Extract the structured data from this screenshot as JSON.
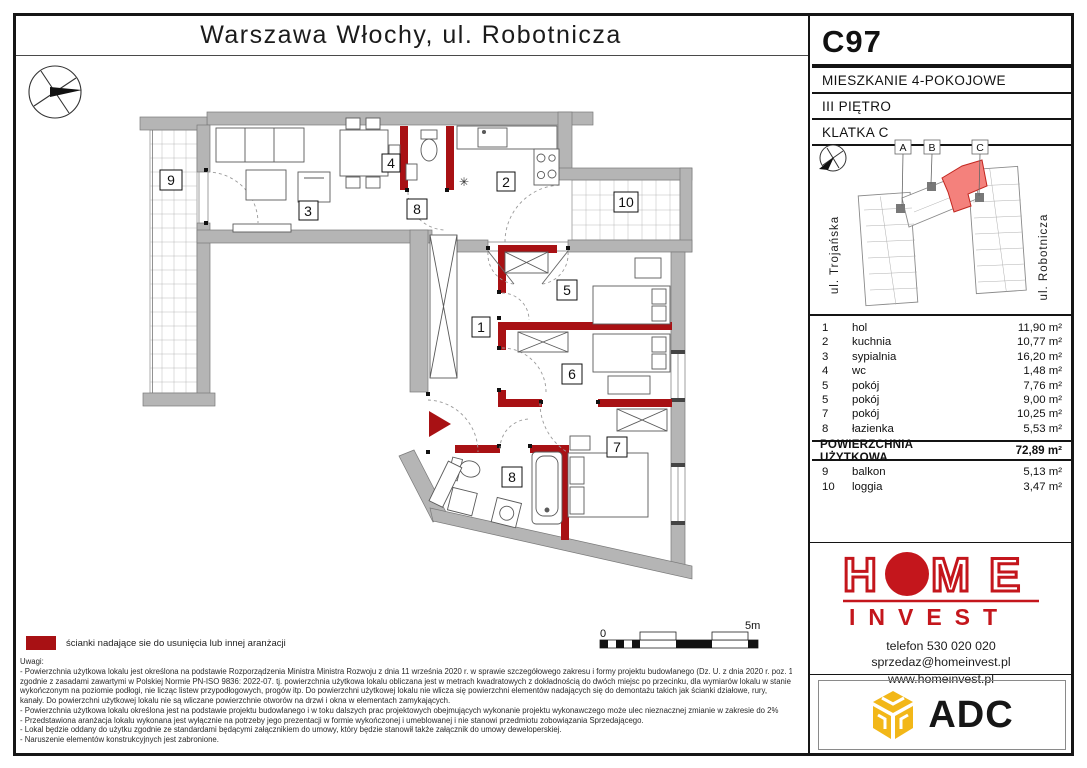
{
  "title": "Warszawa Włochy, ul. Robotnicza",
  "unit": {
    "code": "C97",
    "type": "MIESZKANIE 4-POKOJOWE",
    "floor": "III PIĘTRO",
    "staircase": "KLATKA C"
  },
  "map": {
    "building_labels": [
      "A",
      "B",
      "C"
    ],
    "street_left": "ul. Trojańska",
    "street_right": "ul. Robotnicza"
  },
  "table": {
    "rooms": [
      {
        "no": "1",
        "name": "hol",
        "area": "11,90 m²"
      },
      {
        "no": "2",
        "name": "kuchnia",
        "area": "10,77 m²"
      },
      {
        "no": "3",
        "name": "sypialnia",
        "area": "16,20 m²"
      },
      {
        "no": "4",
        "name": "wc",
        "area": "1,48 m²"
      },
      {
        "no": "5",
        "name": "pokój",
        "area": "7,76 m²"
      },
      {
        "no": "5",
        "name": "pokój",
        "area": "9,00 m²"
      },
      {
        "no": "7",
        "name": "pokój",
        "area": "10,25 m²"
      },
      {
        "no": "8",
        "name": "łazienka",
        "area": "5,53 m²"
      }
    ],
    "total_label": "POWIERZCHNIA UŻYTKOWA",
    "total_area": "72,89 m²",
    "outdoor": [
      {
        "no": "9",
        "name": "balkon",
        "area": "5,13 m²"
      },
      {
        "no": "10",
        "name": "loggia",
        "area": "3,47 m²"
      }
    ]
  },
  "plan": {
    "labels": [
      "9",
      "3",
      "4",
      "8",
      "2",
      "10",
      "5",
      "1",
      "6",
      "7",
      "8"
    ],
    "asterisk": "✳"
  },
  "scalebar": {
    "start": "0",
    "end": "5m"
  },
  "legend": {
    "text": "ścianki nadające sie do usunięcia lub innej aranżacji"
  },
  "notes": {
    "heading": "Uwagi:",
    "lines": [
      "- Powierzchnia użytkowa lokalu jest określona na podstawie Rozporządzenia Ministra Ministra Rozwoju z dnia 11 września 2020 r. w sprawie szczegółowego zakresu i formy projektu budowlanego (Dz. U. z dnia 2020 r. poz. 1609)",
      "zgodnie z zasadami zawartymi w Polskiej Normie PN-ISO 9836: 2022-07. tj. powierzchnia użytkowa lokalu obliczana jest w metrach kwadratowych z dokładnością do dwóch miejsc po przecinku, dla wymiarów lokalu w stanie",
      "wykończonym na poziomie podłogi, nie licząc listew przypodłogowych, progów itp. Do powierzchni użytkowej lokalu nie wlicza się powierzchni elementów nadających się do demontażu takich jak ścianki działowe, rury,",
      "kanały. Do powierzchni użytkowej lokalu nie są wliczane powierzchnie otworów na drzwi i okna w elementach zamykających.",
      "- Powierzchnia użytkowa lokalu określona jest na podstawie projektu budowlanego i w toku dalszych prac projektowych obejmujących wykonanie projektu wykonawczego może ulec nieznacznej zmianie w zakresie do 2%",
      "- Przedstawiona aranżacja lokalu wykonana jest wyłącznie na potrzeby jego prezentacji w formie wykończonej i umeblowanej i nie stanowi przedmiotu zobowiązania Sprzedającego.",
      "- Lokal będzie oddany do użytku zgodnie ze standardami będącymi załącznikiem do umowy, który będzie stanowił także załącznik do umowy deweloperskiej.",
      "- Naruszenie elementów konstrukcyjnych jest zabronione."
    ]
  },
  "brand": {
    "logo_h": "H",
    "logo_m": "M",
    "logo_e": "E",
    "logo_invest": "INVEST",
    "phone": "telefon 530 020 020",
    "email": "sprzedaz@homeinvest.pl",
    "website": "www.homeinvest.pl",
    "partner": "ADC"
  },
  "colors": {
    "wall": "#b5b5b5",
    "partition": "#a81114",
    "brand_red": "#c4161c",
    "adc_gold": "#f2b718",
    "map_highlight": "#f4817c"
  }
}
